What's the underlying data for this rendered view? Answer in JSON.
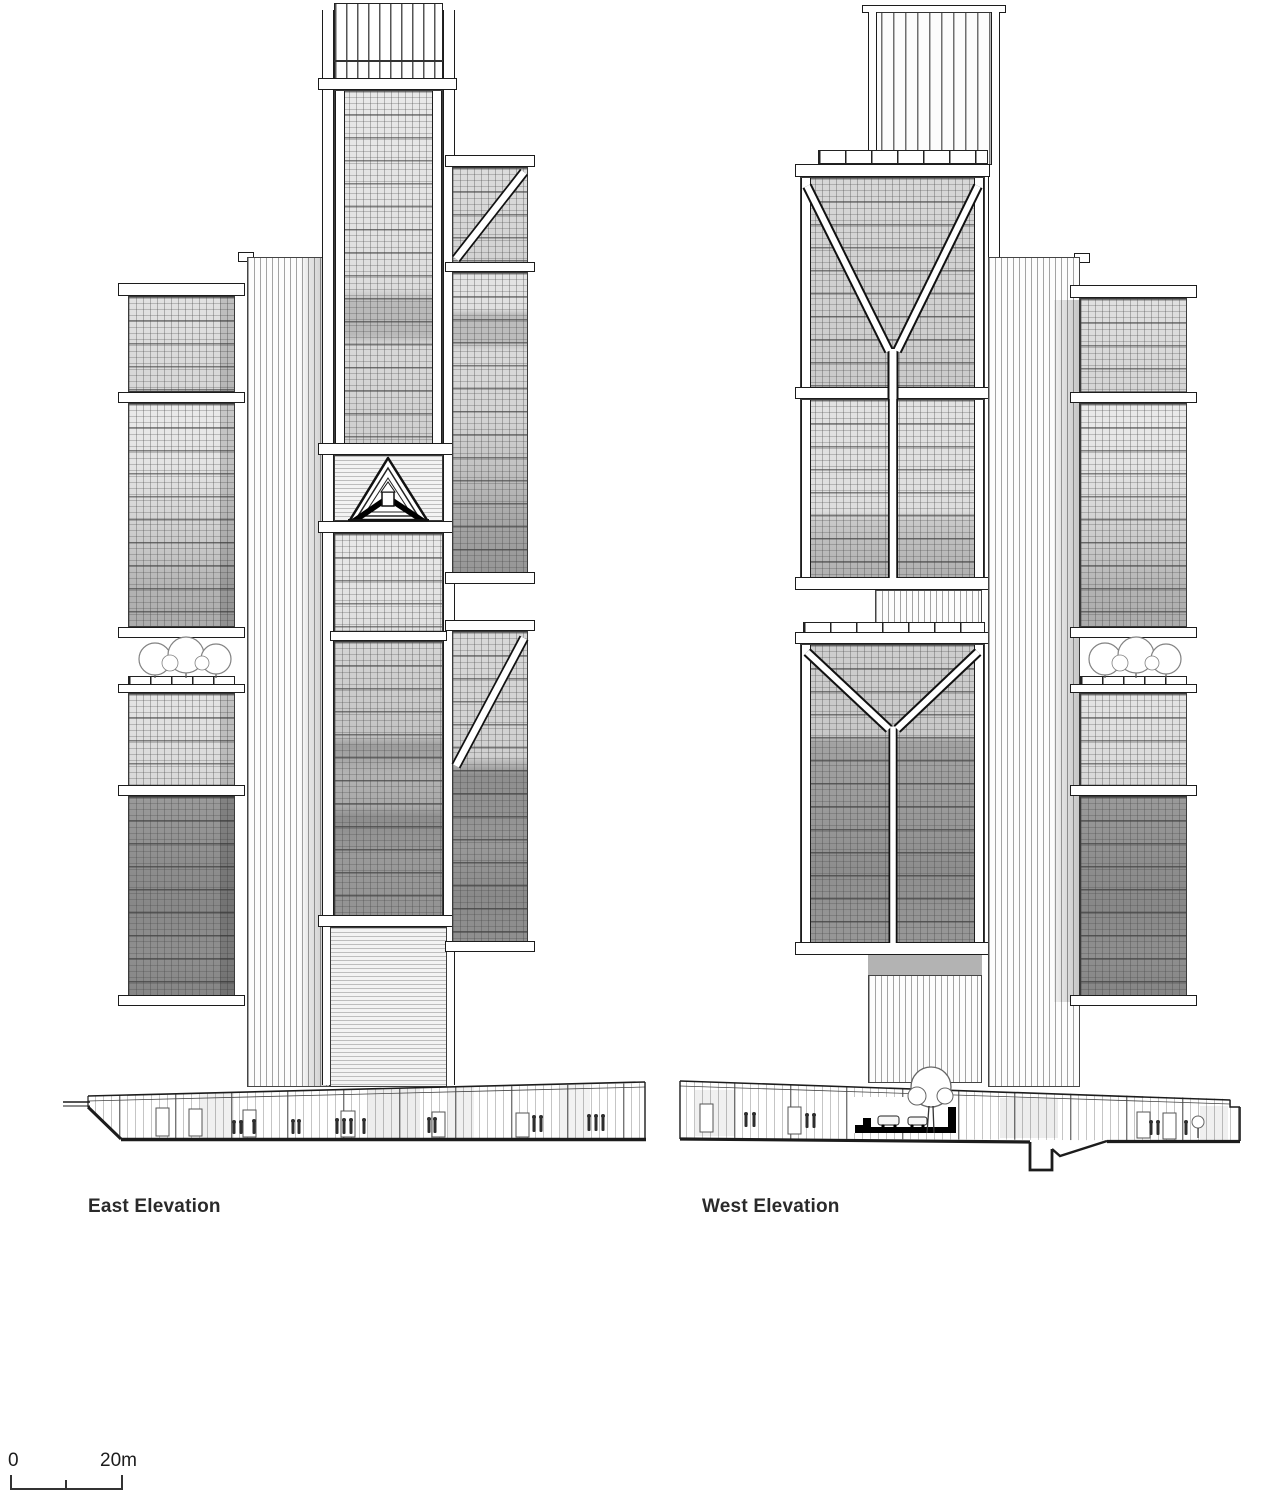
{
  "drawing": {
    "type": "architectural-elevation-drawing",
    "sheet_background": "#ffffff",
    "line_color": "#1c1c1c"
  },
  "elevations": [
    {
      "id": "east",
      "label": "East Elevation"
    },
    {
      "id": "west",
      "label": "West Elevation"
    }
  ],
  "scale_bar": {
    "start_label": "0",
    "end_label": "20m"
  },
  "icons": {
    "tree_icon": "circle-cluster-tree-symbol",
    "person_icon": "scale-figure-symbol",
    "car_icon": "car-outline-symbol"
  },
  "colors": {
    "glass_light": "#e6e6e6",
    "glass_medium": "#c2c2c2",
    "glass_dark": "#8e8e8e",
    "core_stripe": "#a2a2a2",
    "shadow": "rgba(0,0,0,0.18)"
  }
}
